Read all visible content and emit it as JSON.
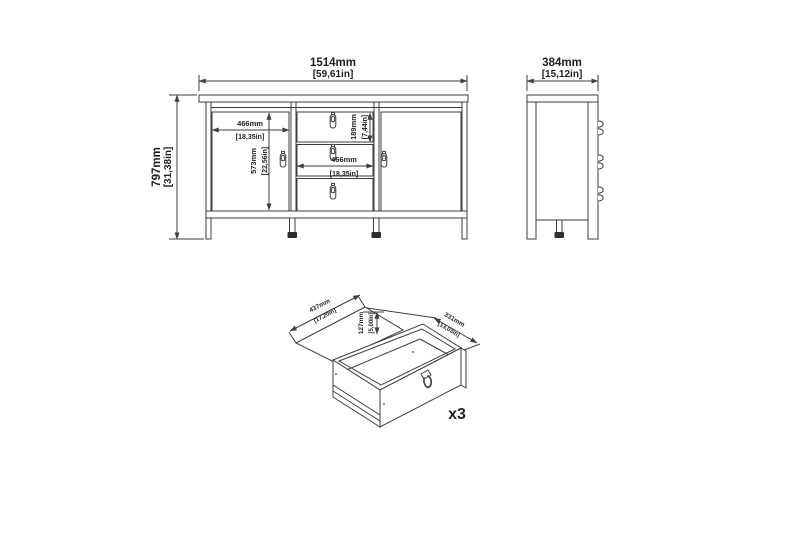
{
  "colors": {
    "line": "#3e3e3e",
    "text": "#1f1f1f",
    "background": "#ffffff",
    "foot_fill": "#2e2e2e"
  },
  "front_view": {
    "overall_width": {
      "mm": "1514mm",
      "inch": "[59,61in]"
    },
    "overall_height": {
      "mm": "797mm",
      "inch": "[31,38in]"
    },
    "door_width": {
      "mm": "466mm",
      "inch": "[18,35in]"
    },
    "door_height": {
      "mm": "573mm",
      "inch": "[22,56in]"
    },
    "drawer_height": {
      "mm": "189mm",
      "inch": "[7,44in]"
    },
    "drawer_width": {
      "mm": "466mm",
      "inch": "[18,35in]"
    }
  },
  "side_view": {
    "depth": {
      "mm": "384mm",
      "inch": "[15,12in]"
    }
  },
  "drawer_detail": {
    "inner_width": {
      "mm": "437mm",
      "inch": "[17,20in]"
    },
    "inner_height": {
      "mm": "127mm",
      "inch": "[5,00in]"
    },
    "inner_depth": {
      "mm": "331mm",
      "inch": "[13,03in]"
    },
    "quantity": "x3"
  }
}
